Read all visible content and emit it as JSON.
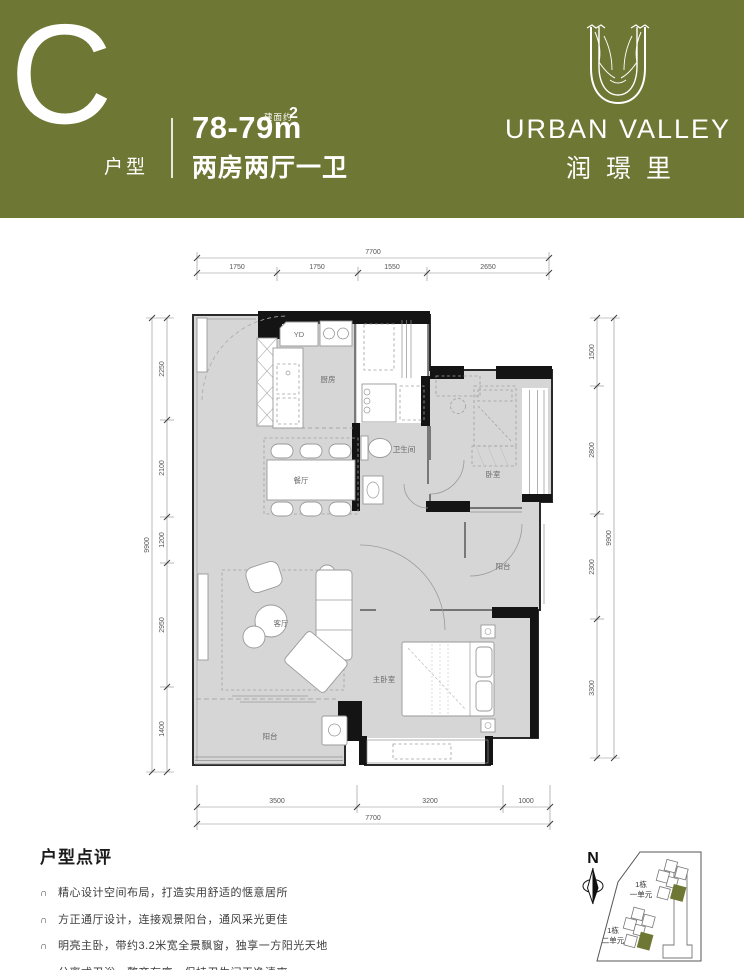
{
  "colors": {
    "accent": "#6E7733",
    "floor": "#D6D6D6",
    "wall": "#141414"
  },
  "header": {
    "unit_letter": "C",
    "unit_type": "户型",
    "area": "78-79m",
    "area_note": "建面约",
    "area_sup": "2",
    "layout": "两房两厅一卫",
    "brand_name": "URBAN VALLEY",
    "brand_cn": "润璟里"
  },
  "plan": {
    "dims": {
      "top_total": "7700",
      "top_segs": [
        "1750",
        "1750",
        "1550",
        "2650"
      ],
      "left_total": "9900",
      "left_segs": [
        "2250",
        "2100",
        "1200",
        "2950",
        "1400"
      ],
      "right_total": "9900",
      "right_segs": [
        "1500",
        "2800",
        "2300",
        "3300"
      ],
      "bottom_total": "7700",
      "bottom_segs": [
        "3500",
        "3200",
        "1000"
      ]
    },
    "rooms": {
      "yd": "YD",
      "kitchen": "厨房",
      "dining": "餐厅",
      "bath": "卫生间",
      "bedroom": "卧室",
      "balcony_right": "阳台",
      "living": "客厅",
      "master": "主卧室",
      "balcony_bottom": "阳台"
    }
  },
  "review": {
    "title": "户型点评",
    "bullet_icon": "∩",
    "bullets": [
      "精心设计空间布局，打造实用舒适的惬意居所",
      "方正通厅设计，连接观景阳台，通风采光更佳",
      "明亮主卧，带约3.2米宽全景飘窗，独享一方阳光天地",
      "分离式卫浴，整齐有序，保持卫生间干净清爽"
    ]
  },
  "site": {
    "north": "N",
    "buildings": [
      {
        "l1": "1栋",
        "l2": "一单元"
      },
      {
        "l1": "1栋",
        "l2": "二单元"
      }
    ]
  }
}
